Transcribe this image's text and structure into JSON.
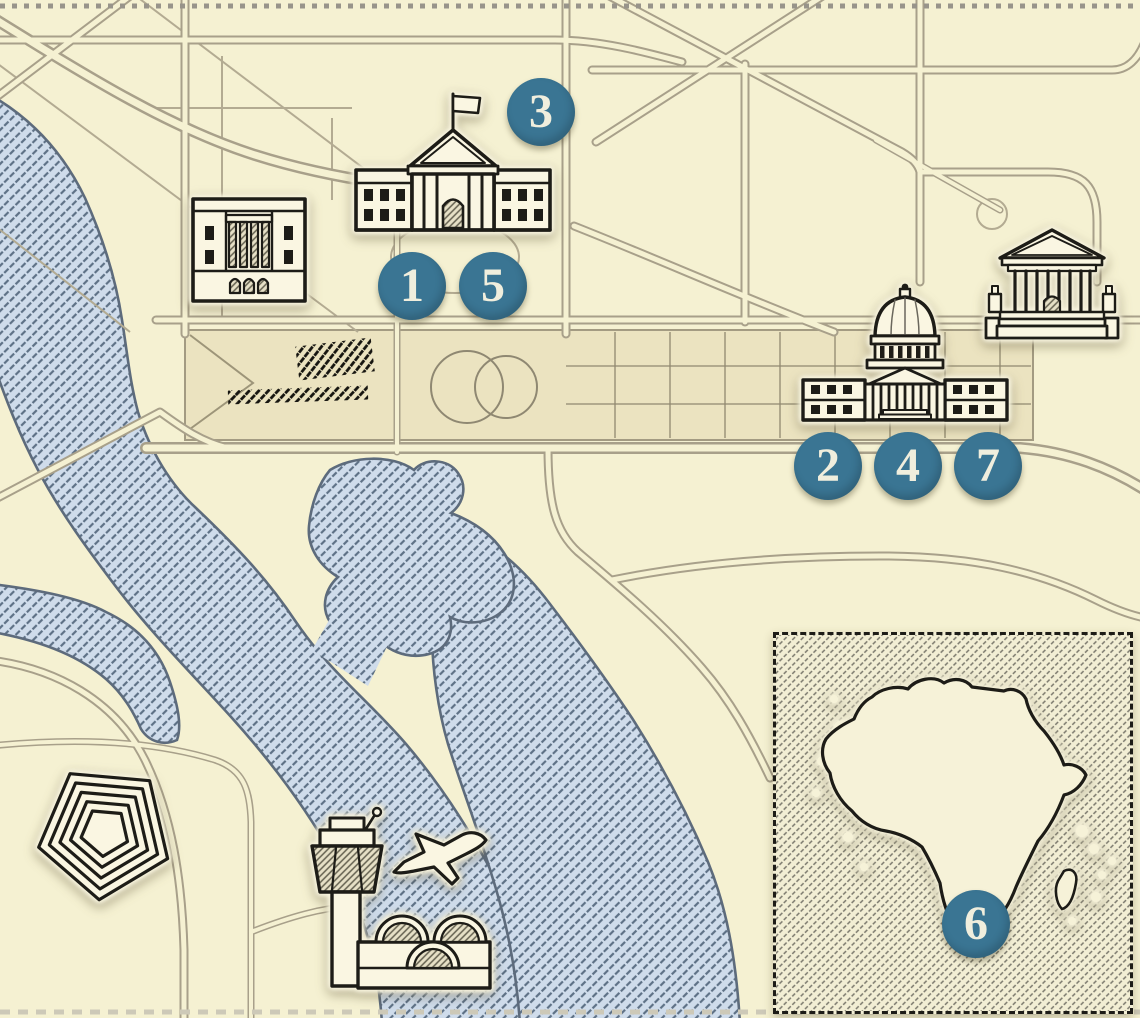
{
  "map": {
    "style": "illustrated-hand-drawn",
    "markers": "numbered location hotspots 1-7"
  },
  "markers": [
    {
      "label": "1",
      "area": "white-house-south-lawn"
    },
    {
      "label": "2",
      "area": "us-capitol"
    },
    {
      "label": "3",
      "area": "white-house"
    },
    {
      "label": "4",
      "area": "us-capitol"
    },
    {
      "label": "5",
      "area": "white-house-south-lawn"
    },
    {
      "label": "6",
      "area": "africa-inset"
    },
    {
      "label": "7",
      "area": "us-capitol"
    }
  ],
  "landmark_icons": [
    "white-house-icon",
    "federal-building-icon",
    "us-capitol-icon",
    "supreme-court-icon",
    "pentagon-icon",
    "control-tower-icon",
    "airport-terminal-icon",
    "airplane-icon",
    "africa-map-icon",
    "madagascar-icon"
  ],
  "colors": {
    "land": "#f5f1d2",
    "mall": "#ebe3c0",
    "road_casing": "#a8a08a",
    "thin_street": "#b3ab92",
    "water_fill": "#cfdceb",
    "water_hatch": "#5e7186",
    "water_outline": "#5d6b7c",
    "ink": "#1d1c17",
    "sticker_halo": "#f8f4de",
    "marker_fill": "#3a7593",
    "marker_text": "#f0eedd",
    "inset_hatch": "#7a786c"
  }
}
